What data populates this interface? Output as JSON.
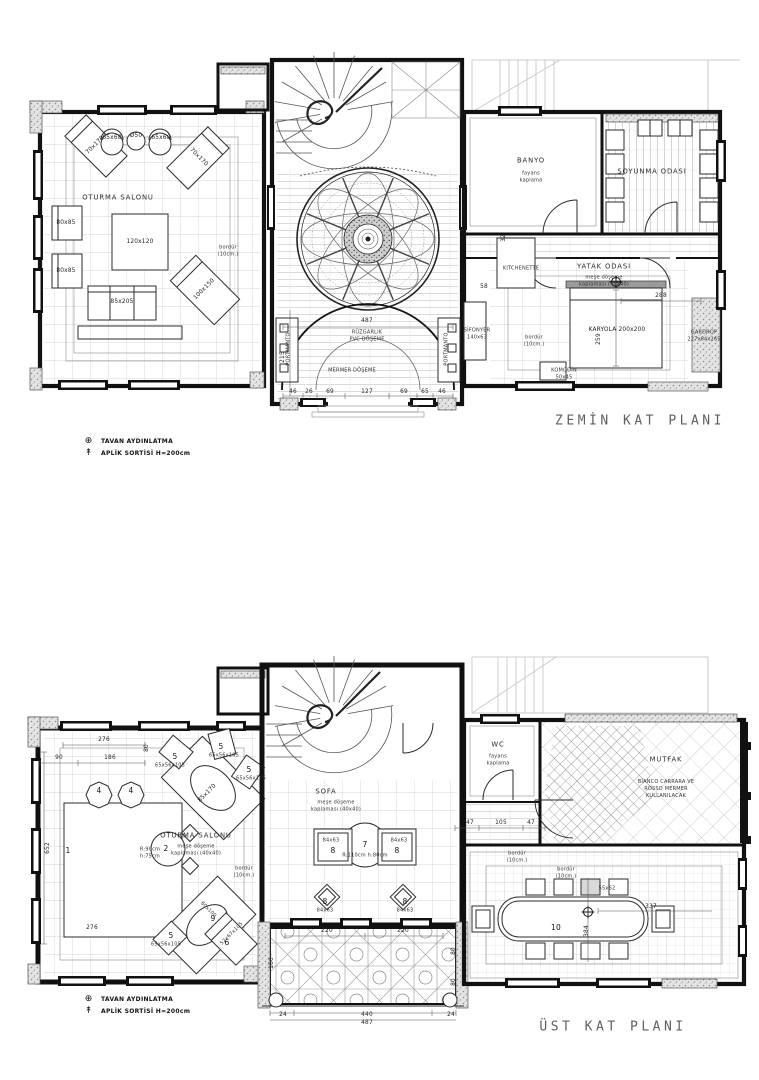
{
  "palette": {
    "paper": "#ffffff",
    "ink": "#111111",
    "grid_gray": "#c7c7c7",
    "ghost_gray": "#c9c9c9",
    "title_gray": "#5f5f5f"
  },
  "legend": {
    "items": [
      {
        "symbol": "⊕",
        "label": "TAVAN AYDINLATMA"
      },
      {
        "symbol": "↟",
        "label": "APLİK SORTİSİ H=200cm"
      }
    ]
  },
  "ground_floor": {
    "title": "ZEMİN KAT PLANI",
    "labels": [
      {
        "n": "room-oturma-salonu",
        "t": "OTURMA SALONU",
        "x": 118,
        "y": 198,
        "c": "room"
      },
      {
        "n": "furn-orta-sehpa",
        "t": "120x120",
        "x": 140,
        "y": 243,
        "c": "dim"
      },
      {
        "n": "furn-berjer-1",
        "t": "80x85",
        "x": 66,
        "y": 224,
        "c": "dim"
      },
      {
        "n": "furn-berjer-2",
        "t": "80x85",
        "x": 66,
        "y": 272,
        "c": "dim"
      },
      {
        "n": "furn-kanepe",
        "t": "85x205",
        "x": 122,
        "y": 303,
        "c": "dim"
      },
      {
        "n": "furn-sezlong-1",
        "t": "100x150",
        "x": 205,
        "y": 290,
        "c": "dim",
        "r": -45
      },
      {
        "n": "furn-sezlong-2",
        "t": "70x170",
        "x": 96,
        "y": 146,
        "c": "dim",
        "r": -45
      },
      {
        "n": "furn-koltuk-1",
        "t": "65x68",
        "x": 112,
        "y": 139,
        "c": "dim"
      },
      {
        "n": "furn-koltuk-2",
        "t": "65x68",
        "x": 161,
        "y": 139,
        "c": "dim"
      },
      {
        "n": "furn-yan-sehpa",
        "t": "Ø50",
        "x": 136,
        "y": 137,
        "c": "dim"
      },
      {
        "n": "furn-sezlong-3",
        "t": "70x170",
        "x": 198,
        "y": 158,
        "c": "dim",
        "r": 45
      },
      {
        "n": "note-bordur-salon",
        "t": "bordür\n(10cm.)",
        "x": 228,
        "y": 251,
        "c": "tiny"
      },
      {
        "n": "room-ruzgarlik",
        "t": "RÜZGARLIK\nPVC DÖŞEME",
        "x": 367,
        "y": 336,
        "c": "tiny"
      },
      {
        "n": "room-mermer-doseme",
        "t": "MERMER DÖŞEME",
        "x": 352,
        "y": 371,
        "c": "tiny"
      },
      {
        "n": "furn-portmanto-sol",
        "t": "PORTMANTO",
        "x": 289,
        "y": 349,
        "c": "tiny",
        "r": -90
      },
      {
        "n": "furn-portmanto-sag",
        "t": "PORTMANTO",
        "x": 447,
        "y": 349,
        "c": "tiny",
        "r": -90
      },
      {
        "n": "dim-giris-487",
        "t": "487",
        "x": 367,
        "y": 322,
        "c": "dim"
      },
      {
        "n": "dim-giris-215",
        "t": "215",
        "x": 284,
        "y": 357,
        "c": "dim",
        "r": -90
      },
      {
        "n": "dim-46a",
        "t": "46",
        "x": 293,
        "y": 393,
        "c": "dim"
      },
      {
        "n": "dim-26",
        "t": "26",
        "x": 309,
        "y": 393,
        "c": "dim"
      },
      {
        "n": "dim-69a",
        "t": "69",
        "x": 330,
        "y": 393,
        "c": "dim"
      },
      {
        "n": "dim-127",
        "t": "127",
        "x": 367,
        "y": 393,
        "c": "dim"
      },
      {
        "n": "dim-69b",
        "t": "69",
        "x": 404,
        "y": 393,
        "c": "dim"
      },
      {
        "n": "dim-65",
        "t": "65",
        "x": 425,
        "y": 393,
        "c": "dim"
      },
      {
        "n": "dim-46b",
        "t": "46",
        "x": 442,
        "y": 393,
        "c": "dim"
      },
      {
        "n": "room-banyo",
        "t": "BANYO",
        "x": 531,
        "y": 161,
        "c": "room"
      },
      {
        "n": "note-banyo",
        "t": "fayans\nkaplama",
        "x": 531,
        "y": 177,
        "c": "tiny"
      },
      {
        "n": "room-soyunma-odasi",
        "t": "SOYUNMA ODASI",
        "x": 652,
        "y": 172,
        "c": "room"
      },
      {
        "n": "room-kitchenette",
        "t": "KITCHENETTE",
        "x": 521,
        "y": 269,
        "c": "tiny"
      },
      {
        "n": "room-yatak-odasi",
        "t": "YATAK ODASI",
        "x": 604,
        "y": 267,
        "c": "room"
      },
      {
        "n": "note-yatak-doseme",
        "t": "meşe döşeme\nkaplaması (40x40)",
        "x": 604,
        "y": 281,
        "c": "tiny"
      },
      {
        "n": "furn-karyola",
        "t": "KARYOLA 200x200",
        "x": 617,
        "y": 331,
        "c": "dim"
      },
      {
        "n": "note-bordur-yatak",
        "t": "bordür\n(10cm.)",
        "x": 534,
        "y": 341,
        "c": "tiny"
      },
      {
        "n": "furn-komodin",
        "t": "KOMODİN\n50x45",
        "x": 564,
        "y": 374,
        "c": "tiny"
      },
      {
        "n": "furn-sifonyer",
        "t": "SİFONYER\n140x63",
        "x": 477,
        "y": 334,
        "c": "tiny"
      },
      {
        "n": "furn-gardrop",
        "t": "GARDROP\n227x64x265",
        "x": 704,
        "y": 336,
        "c": "tiny"
      },
      {
        "n": "dim-yatak-288",
        "t": "288",
        "x": 661,
        "y": 297,
        "c": "dim"
      },
      {
        "n": "dim-yatak-259",
        "t": "259",
        "x": 600,
        "y": 339,
        "c": "dim",
        "r": -90
      },
      {
        "n": "dim-kapi-32",
        "t": "32",
        "x": 505,
        "y": 238,
        "c": "dim",
        "r": -90
      },
      {
        "n": "dim-58",
        "t": "58",
        "x": 484,
        "y": 288,
        "c": "dim"
      }
    ]
  },
  "upper_floor": {
    "title": "ÜST KAT PLANI",
    "labels": [
      {
        "n": "dim-276-ust",
        "t": "276",
        "x": 104,
        "y": 741,
        "c": "dim"
      },
      {
        "n": "dim-90",
        "t": "90",
        "x": 59,
        "y": 759,
        "c": "dim"
      },
      {
        "n": "dim-186",
        "t": "186",
        "x": 110,
        "y": 759,
        "c": "dim"
      },
      {
        "n": "dim-80-sol",
        "t": "80",
        "x": 148,
        "y": 748,
        "c": "dim",
        "r": -90
      },
      {
        "n": "dim-652",
        "t": "652",
        "x": 49,
        "y": 848,
        "c": "dim",
        "r": -90
      },
      {
        "n": "num-4a",
        "t": "4",
        "x": 99,
        "y": 791,
        "c": "num"
      },
      {
        "n": "num-4b",
        "t": "4",
        "x": 131,
        "y": 791,
        "c": "num"
      },
      {
        "n": "num-1-hali",
        "t": "1",
        "x": 68,
        "y": 851,
        "c": "num"
      },
      {
        "n": "num-2-masa",
        "t": "2",
        "x": 166,
        "y": 849,
        "c": "num"
      },
      {
        "n": "note-r90",
        "t": "R:90cm\nh:75cm",
        "x": 150,
        "y": 853,
        "c": "tiny"
      },
      {
        "n": "num-5a",
        "t": "5",
        "x": 175,
        "y": 757,
        "c": "num"
      },
      {
        "n": "dim-5a",
        "t": "65x56x105",
        "x": 170,
        "y": 766,
        "c": "tiny"
      },
      {
        "n": "num-5b",
        "t": "5",
        "x": 221,
        "y": 747,
        "c": "num"
      },
      {
        "n": "dim-5b",
        "t": "65x56x105",
        "x": 224,
        "y": 756,
        "c": "tiny"
      },
      {
        "n": "num-5c",
        "t": "5",
        "x": 249,
        "y": 770,
        "c": "num"
      },
      {
        "n": "dim-5c",
        "t": "65x56x105",
        "x": 251,
        "y": 779,
        "c": "tiny"
      },
      {
        "n": "furn-kanepe-ust",
        "t": "85x170",
        "x": 208,
        "y": 794,
        "c": "dim",
        "r": -45
      },
      {
        "n": "room-oturma-ust",
        "t": "OTURMA SALONU",
        "x": 196,
        "y": 836,
        "c": "room"
      },
      {
        "n": "note-oturma-doseme",
        "t": "meşe döşeme\nkaplaması (40x40)",
        "x": 196,
        "y": 850,
        "c": "tiny"
      },
      {
        "n": "note-bordur-oturma",
        "t": "bordür\n(10cm.)",
        "x": 244,
        "y": 872,
        "c": "tiny"
      },
      {
        "n": "num-9",
        "t": "9",
        "x": 213,
        "y": 919,
        "c": "num"
      },
      {
        "n": "dim-9",
        "t": "60x100",
        "x": 208,
        "y": 910,
        "c": "tiny",
        "r": 45
      },
      {
        "n": "num-5d",
        "t": "5",
        "x": 171,
        "y": 936,
        "c": "num"
      },
      {
        "n": "dim-5d",
        "t": "65x56x105",
        "x": 166,
        "y": 945,
        "c": "tiny"
      },
      {
        "n": "num-6",
        "t": "6",
        "x": 227,
        "y": 943,
        "c": "num"
      },
      {
        "n": "dim-6",
        "t": "52x67x105",
        "x": 232,
        "y": 934,
        "c": "tiny",
        "r": -45
      },
      {
        "n": "dim-276-alt",
        "t": "276",
        "x": 92,
        "y": 929,
        "c": "dim"
      },
      {
        "n": "room-sofa",
        "t": "SOFA",
        "x": 326,
        "y": 792,
        "c": "room"
      },
      {
        "n": "note-sofa-doseme",
        "t": "meşe döşeme\nkaplaması (40x40)",
        "x": 336,
        "y": 806,
        "c": "tiny"
      },
      {
        "n": "num-7",
        "t": "7",
        "x": 365,
        "y": 845,
        "c": "num"
      },
      {
        "n": "note-r110",
        "t": "R:110cm h:80cm",
        "x": 365,
        "y": 856,
        "c": "tiny"
      },
      {
        "n": "num-8a",
        "t": "8",
        "x": 333,
        "y": 851,
        "c": "num"
      },
      {
        "n": "dim-8a",
        "t": "84x63",
        "x": 331,
        "y": 841,
        "c": "tiny"
      },
      {
        "n": "num-8b",
        "t": "8",
        "x": 397,
        "y": 851,
        "c": "num"
      },
      {
        "n": "dim-8b",
        "t": "84x63",
        "x": 399,
        "y": 841,
        "c": "tiny"
      },
      {
        "n": "num-8c",
        "t": "8",
        "x": 325,
        "y": 902,
        "c": "num"
      },
      {
        "n": "dim-8c",
        "t": "84x63",
        "x": 325,
        "y": 911,
        "c": "tiny"
      },
      {
        "n": "num-8d",
        "t": "8",
        "x": 405,
        "y": 902,
        "c": "num"
      },
      {
        "n": "dim-8d",
        "t": "84x63",
        "x": 405,
        "y": 911,
        "c": "tiny"
      },
      {
        "n": "dim-47a",
        "t": "47",
        "x": 470,
        "y": 824,
        "c": "dim"
      },
      {
        "n": "dim-105",
        "t": "105",
        "x": 501,
        "y": 824,
        "c": "dim"
      },
      {
        "n": "dim-47b",
        "t": "47",
        "x": 531,
        "y": 824,
        "c": "dim"
      },
      {
        "n": "room-wc",
        "t": "WC",
        "x": 498,
        "y": 745,
        "c": "room"
      },
      {
        "n": "note-wc",
        "t": "fayans\nkaplama",
        "x": 498,
        "y": 760,
        "c": "tiny"
      },
      {
        "n": "room-mutfak",
        "t": "MUTFAK",
        "x": 666,
        "y": 760,
        "c": "room"
      },
      {
        "n": "note-mutfak",
        "t": "BİANCO CARRARA VE\nROSSO MERMER\nKULLANILACAK",
        "x": 666,
        "y": 789,
        "c": "tiny"
      },
      {
        "n": "note-bordur-yemek-1",
        "t": "bordür\n(10cm.)",
        "x": 517,
        "y": 857,
        "c": "tiny"
      },
      {
        "n": "note-bordur-yemek-2",
        "t": "bordür\n(10cm.)",
        "x": 566,
        "y": 873,
        "c": "tiny"
      },
      {
        "n": "num-10-masa",
        "t": "10",
        "x": 556,
        "y": 928,
        "c": "num"
      },
      {
        "n": "dim-sandalye",
        "t": "55x62",
        "x": 607,
        "y": 889,
        "c": "tiny"
      },
      {
        "n": "dim-337",
        "t": "337",
        "x": 651,
        "y": 908,
        "c": "dim"
      },
      {
        "n": "dim-384",
        "t": "384",
        "x": 588,
        "y": 931,
        "c": "dim",
        "r": -90
      },
      {
        "n": "dim-220a",
        "t": "220",
        "x": 327,
        "y": 932,
        "c": "dim"
      },
      {
        "n": "dim-220b",
        "t": "220",
        "x": 403,
        "y": 932,
        "c": "dim"
      },
      {
        "n": "dim-160",
        "t": "160",
        "x": 273,
        "y": 963,
        "c": "dim",
        "r": -90
      },
      {
        "n": "dim-80a",
        "t": "80",
        "x": 455,
        "y": 951,
        "c": "dim",
        "r": -90
      },
      {
        "n": "dim-80b",
        "t": "80",
        "x": 455,
        "y": 982,
        "c": "dim",
        "r": -90
      },
      {
        "n": "dim-24a",
        "t": "24",
        "x": 283,
        "y": 1016,
        "c": "dim"
      },
      {
        "n": "dim-440",
        "t": "440",
        "x": 367,
        "y": 1016,
        "c": "dim"
      },
      {
        "n": "dim-24b",
        "t": "24",
        "x": 451,
        "y": 1016,
        "c": "dim"
      },
      {
        "n": "dim-487-ust",
        "t": "487",
        "x": 367,
        "y": 1024,
        "c": "dim"
      }
    ]
  }
}
